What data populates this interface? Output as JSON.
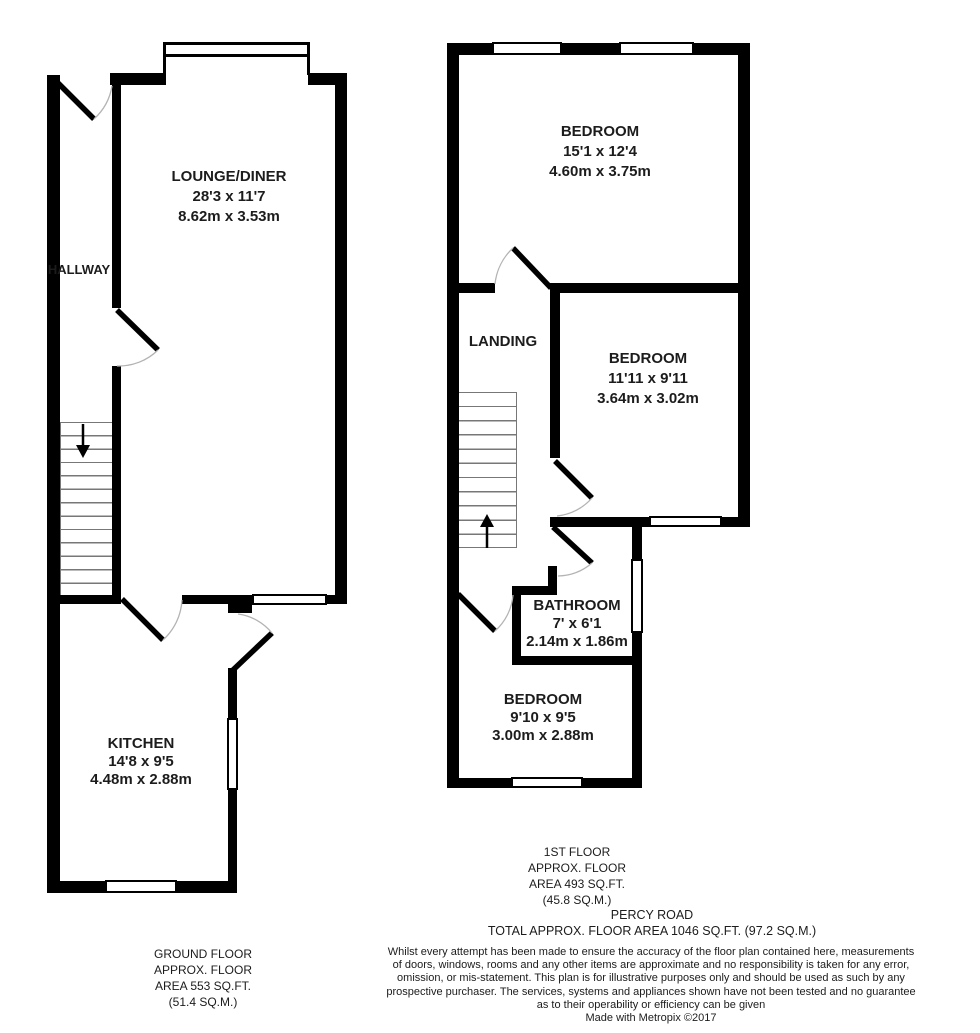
{
  "plan": {
    "ground_floor": {
      "hallway_label": "HALLWAY",
      "lounge": {
        "name": "LOUNGE/DINER",
        "imperial": "28'3 x 11'7",
        "metric": "8.62m x 3.53m"
      },
      "kitchen": {
        "name": "KITCHEN",
        "imperial": "14'8 x 9'5",
        "metric": "4.48m x 2.88m"
      },
      "caption": [
        "GROUND FLOOR",
        "APPROX. FLOOR",
        "AREA 553 SQ.FT.",
        "(51.4 SQ.M.)"
      ]
    },
    "first_floor": {
      "landing_label": "LANDING",
      "bedroom1": {
        "name": "BEDROOM",
        "imperial": "15'1 x 12'4",
        "metric": "4.60m x 3.75m"
      },
      "bedroom2": {
        "name": "BEDROOM",
        "imperial": "11'11 x 9'11",
        "metric": "3.64m x 3.02m"
      },
      "bathroom": {
        "name": "BATHROOM",
        "imperial": "7' x 6'1",
        "metric": "2.14m x 1.86m"
      },
      "bedroom3": {
        "name": "BEDROOM",
        "imperial": "9'10 x 9'5",
        "metric": "3.00m x 2.88m"
      },
      "caption": [
        "1ST FLOOR",
        "APPROX. FLOOR",
        "AREA 493 SQ.FT.",
        "(45.8 SQ.M.)"
      ]
    }
  },
  "footer": {
    "address": "PERCY ROAD",
    "total_area": "TOTAL APPROX. FLOOR AREA 1046 SQ.FT. (97.2 SQ.M.)",
    "disclaimer": [
      "Whilst every attempt has been made to ensure the accuracy of the floor plan contained here, measurements",
      "of doors, windows, rooms and any other items are approximate and no responsibility is taken for any error,",
      "omission, or mis-statement. This plan is for illustrative purposes only and should be used as such by any",
      "prospective purchaser. The services, systems and appliances shown have not been tested and no guarantee",
      "as to their operability or efficiency can be given"
    ],
    "credit": "Made with Metropix ©2017"
  },
  "colors": {
    "wall": "#000000",
    "text": "#1c1c1c",
    "door_arc": "#b3b3b3",
    "background": "#ffffff"
  }
}
